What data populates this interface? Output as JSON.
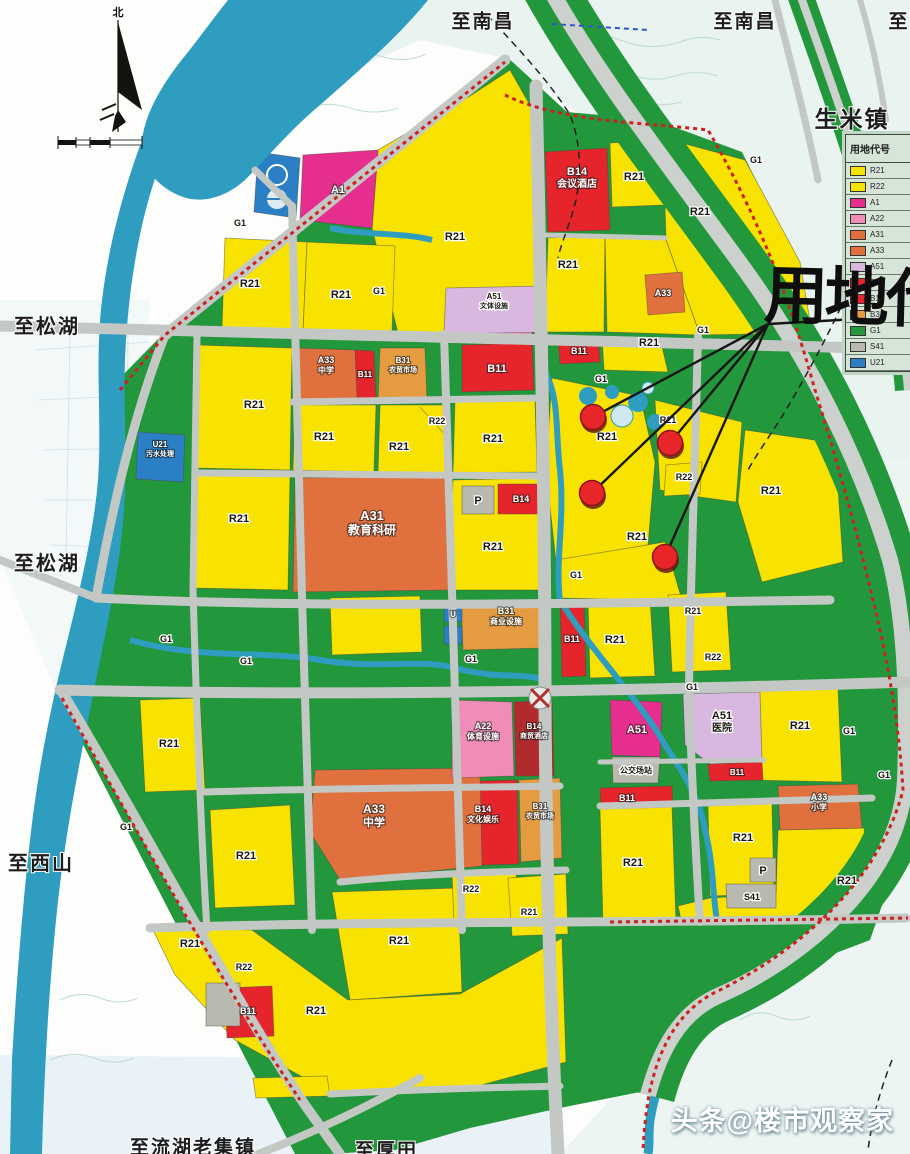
{
  "map": {
    "north_label": "北",
    "annotation_title": "用地代",
    "watermark": "头条@楼市观察家",
    "colors": {
      "residential_R21": "#f8e300",
      "commercial_B": "#e5252b",
      "commercial_dark_B14": "#b02a2e",
      "education_A3": "#e0713f",
      "market_B31": "#e59b40",
      "admin_A1": "#e62e8f",
      "culture_A22": "#f08cb8",
      "hospital_A51": "#d9b8e0",
      "parking_S41": "#b9b9b0",
      "utility_U": "#2b7fc4",
      "green_G1": "#22973b",
      "water": "#2e9dbf",
      "marker": "#e8262a"
    },
    "legend": {
      "header": "用地代号",
      "rows": [
        {
          "code": "R21",
          "color": "#f8e300"
        },
        {
          "code": "R22",
          "color": "#f8e300"
        },
        {
          "code": "A1",
          "color": "#e62e8f"
        },
        {
          "code": "A22",
          "color": "#f08cb8"
        },
        {
          "code": "A31",
          "color": "#e0713f"
        },
        {
          "code": "A33",
          "color": "#e0713f"
        },
        {
          "code": "A51",
          "color": "#d9b8e0"
        },
        {
          "code": "B11",
          "color": "#e5252b"
        },
        {
          "code": "B14",
          "color": "#e5252b"
        },
        {
          "code": "B31",
          "color": "#e59b40"
        },
        {
          "code": "G1",
          "color": "#22973b"
        },
        {
          "code": "S41",
          "color": "#b9b9b0"
        },
        {
          "code": "U21",
          "color": "#2b7fc4"
        }
      ]
    },
    "place_labels": [
      {
        "text": "至南昌",
        "x": 483,
        "y": 16,
        "size": 19
      },
      {
        "text": "至南昌",
        "x": 745,
        "y": 16,
        "size": 19
      },
      {
        "text": "至",
        "x": 899,
        "y": 16,
        "size": 19
      },
      {
        "text": "生米镇",
        "x": 852,
        "y": 113,
        "size": 23
      },
      {
        "text": "至松湖",
        "x": 14,
        "y": 321,
        "size": 20,
        "anchor": "start"
      },
      {
        "text": "至松湖",
        "x": 14,
        "y": 558,
        "size": 20,
        "anchor": "start"
      },
      {
        "text": "至西山",
        "x": 8,
        "y": 858,
        "size": 20,
        "anchor": "start"
      },
      {
        "text": "至流湖老集镇",
        "x": 130,
        "y": 1142,
        "size": 19,
        "anchor": "start"
      },
      {
        "text": "至厚田",
        "x": 355,
        "y": 1145,
        "size": 19,
        "anchor": "start"
      }
    ],
    "parcel_labels": [
      {
        "code": "A1",
        "x": 338,
        "y": 193,
        "s": "w"
      },
      {
        "code": "R21",
        "x": 455,
        "y": 240,
        "s": "d"
      },
      {
        "code": "R21",
        "x": 250,
        "y": 287,
        "s": "d"
      },
      {
        "code": "R21",
        "x": 341,
        "y": 298,
        "s": "d"
      },
      {
        "code": "G1",
        "x": 379,
        "y": 294,
        "s": "d",
        "size": 9
      },
      {
        "code": "G1",
        "x": 240,
        "y": 226,
        "s": "d",
        "size": 9
      },
      {
        "code": "B14",
        "name": "会议酒店",
        "x": 577,
        "y": 178,
        "s": "w"
      },
      {
        "code": "R21",
        "x": 634,
        "y": 180,
        "s": "d"
      },
      {
        "code": "R21",
        "x": 700,
        "y": 215,
        "s": "d"
      },
      {
        "code": "R21",
        "x": 568,
        "y": 268,
        "s": "d"
      },
      {
        "code": "A33",
        "x": 663,
        "y": 296,
        "s": "w",
        "size": 9
      },
      {
        "code": "G1",
        "x": 756,
        "y": 163,
        "s": "d",
        "size": 9
      },
      {
        "code": "R21",
        "x": 649,
        "y": 346,
        "s": "d"
      },
      {
        "code": "G1",
        "x": 703,
        "y": 333,
        "s": "d",
        "size": 9
      },
      {
        "code": "B11",
        "x": 579,
        "y": 354,
        "s": "w",
        "size": 9
      },
      {
        "code": "G1",
        "x": 601,
        "y": 382,
        "s": "d",
        "size": 9
      },
      {
        "code": "R21",
        "x": 607,
        "y": 440,
        "s": "d"
      },
      {
        "code": "R21",
        "x": 668,
        "y": 423,
        "s": "d",
        "size": 9
      },
      {
        "code": "R21",
        "x": 771,
        "y": 494,
        "s": "d"
      },
      {
        "code": "R22",
        "x": 684,
        "y": 480,
        "s": "d",
        "size": 9
      },
      {
        "code": "R21",
        "x": 637,
        "y": 540,
        "s": "d"
      },
      {
        "code": "G1",
        "x": 576,
        "y": 578,
        "s": "d",
        "size": 9
      },
      {
        "code": "A33",
        "name": "中学",
        "x": 326,
        "y": 366,
        "s": "w",
        "size": 9
      },
      {
        "code": "B11",
        "x": 365,
        "y": 377,
        "s": "w",
        "size": 8
      },
      {
        "code": "B31",
        "name": "农贸市场",
        "x": 403,
        "y": 366,
        "s": "w",
        "size": 8
      },
      {
        "code": "R21",
        "x": 254,
        "y": 408,
        "s": "d"
      },
      {
        "code": "R21",
        "x": 324,
        "y": 440,
        "s": "d"
      },
      {
        "code": "R22",
        "x": 437,
        "y": 424,
        "s": "d",
        "size": 9
      },
      {
        "code": "R21",
        "x": 399,
        "y": 450,
        "s": "d"
      },
      {
        "code": "R21",
        "x": 239,
        "y": 522,
        "s": "d"
      },
      {
        "code": "A31",
        "name": "教育科研",
        "x": 372,
        "y": 523,
        "s": "w",
        "size": 13
      },
      {
        "code": "U21",
        "name": "污水处理",
        "x": 160,
        "y": 450,
        "s": "w",
        "size": 8
      },
      {
        "code": "B11",
        "x": 497,
        "y": 372,
        "s": "w"
      },
      {
        "code": "A51",
        "name": "文体设施",
        "x": 494,
        "y": 302,
        "s": "d",
        "size": 8
      },
      {
        "code": "R21",
        "x": 493,
        "y": 442,
        "s": "d"
      },
      {
        "code": "P",
        "x": 478,
        "y": 504,
        "s": "d"
      },
      {
        "code": "B14",
        "x": 521,
        "y": 502,
        "s": "w",
        "size": 9
      },
      {
        "code": "R21",
        "x": 493,
        "y": 550,
        "s": "d"
      },
      {
        "code": "G1",
        "x": 166,
        "y": 642,
        "s": "d",
        "size": 9
      },
      {
        "code": "G1",
        "x": 246,
        "y": 664,
        "s": "d",
        "size": 9
      },
      {
        "code": "B31",
        "name": "商业设施",
        "x": 506,
        "y": 617,
        "s": "w",
        "size": 9
      },
      {
        "code": "U",
        "x": 453,
        "y": 617,
        "s": "w",
        "size": 8
      },
      {
        "code": "G1",
        "x": 471,
        "y": 662,
        "s": "d",
        "size": 9
      },
      {
        "code": "B11",
        "x": 572,
        "y": 642,
        "s": "w",
        "size": 9
      },
      {
        "code": "R21",
        "x": 615,
        "y": 643,
        "s": "d"
      },
      {
        "code": "R21",
        "x": 693,
        "y": 614,
        "s": "d",
        "size": 9
      },
      {
        "code": "R22",
        "x": 713,
        "y": 660,
        "s": "d",
        "size": 9
      },
      {
        "code": "G1",
        "x": 692,
        "y": 690,
        "s": "d",
        "size": 9
      },
      {
        "code": "A22",
        "name": "体育设施",
        "x": 483,
        "y": 732,
        "s": "w",
        "size": 9
      },
      {
        "code": "B14",
        "name": "商贸酒店",
        "x": 534,
        "y": 732,
        "s": "w",
        "size": 8
      },
      {
        "code": "A51",
        "x": 637,
        "y": 733,
        "s": "w"
      },
      {
        "code": "公交场站",
        "x": 636,
        "y": 773,
        "s": "d",
        "size": 8
      },
      {
        "code": "A51",
        "name": "医院",
        "x": 722,
        "y": 722,
        "s": "d"
      },
      {
        "code": "B11",
        "x": 737,
        "y": 775,
        "s": "w",
        "size": 8
      },
      {
        "code": "R21",
        "x": 800,
        "y": 729,
        "s": "d"
      },
      {
        "code": "G1",
        "x": 849,
        "y": 734,
        "s": "d",
        "size": 9
      },
      {
        "code": "G1",
        "x": 884,
        "y": 778,
        "s": "d",
        "size": 9
      },
      {
        "code": "B11",
        "x": 627,
        "y": 801,
        "s": "w",
        "size": 9
      },
      {
        "code": "R21",
        "x": 633,
        "y": 866,
        "s": "d"
      },
      {
        "code": "R21",
        "x": 743,
        "y": 841,
        "s": "d"
      },
      {
        "code": "P",
        "x": 763,
        "y": 874,
        "s": "d"
      },
      {
        "code": "S41",
        "x": 752,
        "y": 900,
        "s": "d",
        "size": 9
      },
      {
        "code": "A33",
        "name": "小学",
        "x": 819,
        "y": 803,
        "s": "w",
        "size": 9
      },
      {
        "code": "R21",
        "x": 847,
        "y": 884,
        "s": "d"
      },
      {
        "code": "A33",
        "name": "中学",
        "x": 374,
        "y": 816,
        "s": "w",
        "size": 12
      },
      {
        "code": "B14",
        "name": "文化娱乐",
        "x": 483,
        "y": 815,
        "s": "w",
        "size": 9
      },
      {
        "code": "B31",
        "name": "农贸市场",
        "x": 540,
        "y": 812,
        "s": "w",
        "size": 8
      },
      {
        "code": "R22",
        "x": 471,
        "y": 892,
        "s": "d",
        "size": 9
      },
      {
        "code": "R21",
        "x": 529,
        "y": 915,
        "s": "d",
        "size": 9
      },
      {
        "code": "R21",
        "x": 399,
        "y": 944,
        "s": "d"
      },
      {
        "code": "R21",
        "x": 190,
        "y": 947,
        "s": "d"
      },
      {
        "code": "R22",
        "x": 244,
        "y": 970,
        "s": "d",
        "size": 9
      },
      {
        "code": "B11",
        "x": 248,
        "y": 1014,
        "s": "w",
        "size": 9
      },
      {
        "code": "R21",
        "x": 316,
        "y": 1014,
        "s": "d"
      },
      {
        "code": "G1",
        "x": 126,
        "y": 830,
        "s": "d",
        "size": 9
      },
      {
        "code": "R21",
        "x": 246,
        "y": 859,
        "s": "d"
      },
      {
        "code": "R21",
        "x": 169,
        "y": 747,
        "s": "d"
      }
    ],
    "markers": {
      "color": "#e8262a",
      "origin": {
        "x": 768,
        "y": 324
      },
      "tail": {
        "x": 910,
        "y": 316
      },
      "points": [
        {
          "x": 593,
          "y": 417
        },
        {
          "x": 670,
          "y": 443
        },
        {
          "x": 592,
          "y": 493
        },
        {
          "x": 665,
          "y": 557
        }
      ]
    }
  }
}
